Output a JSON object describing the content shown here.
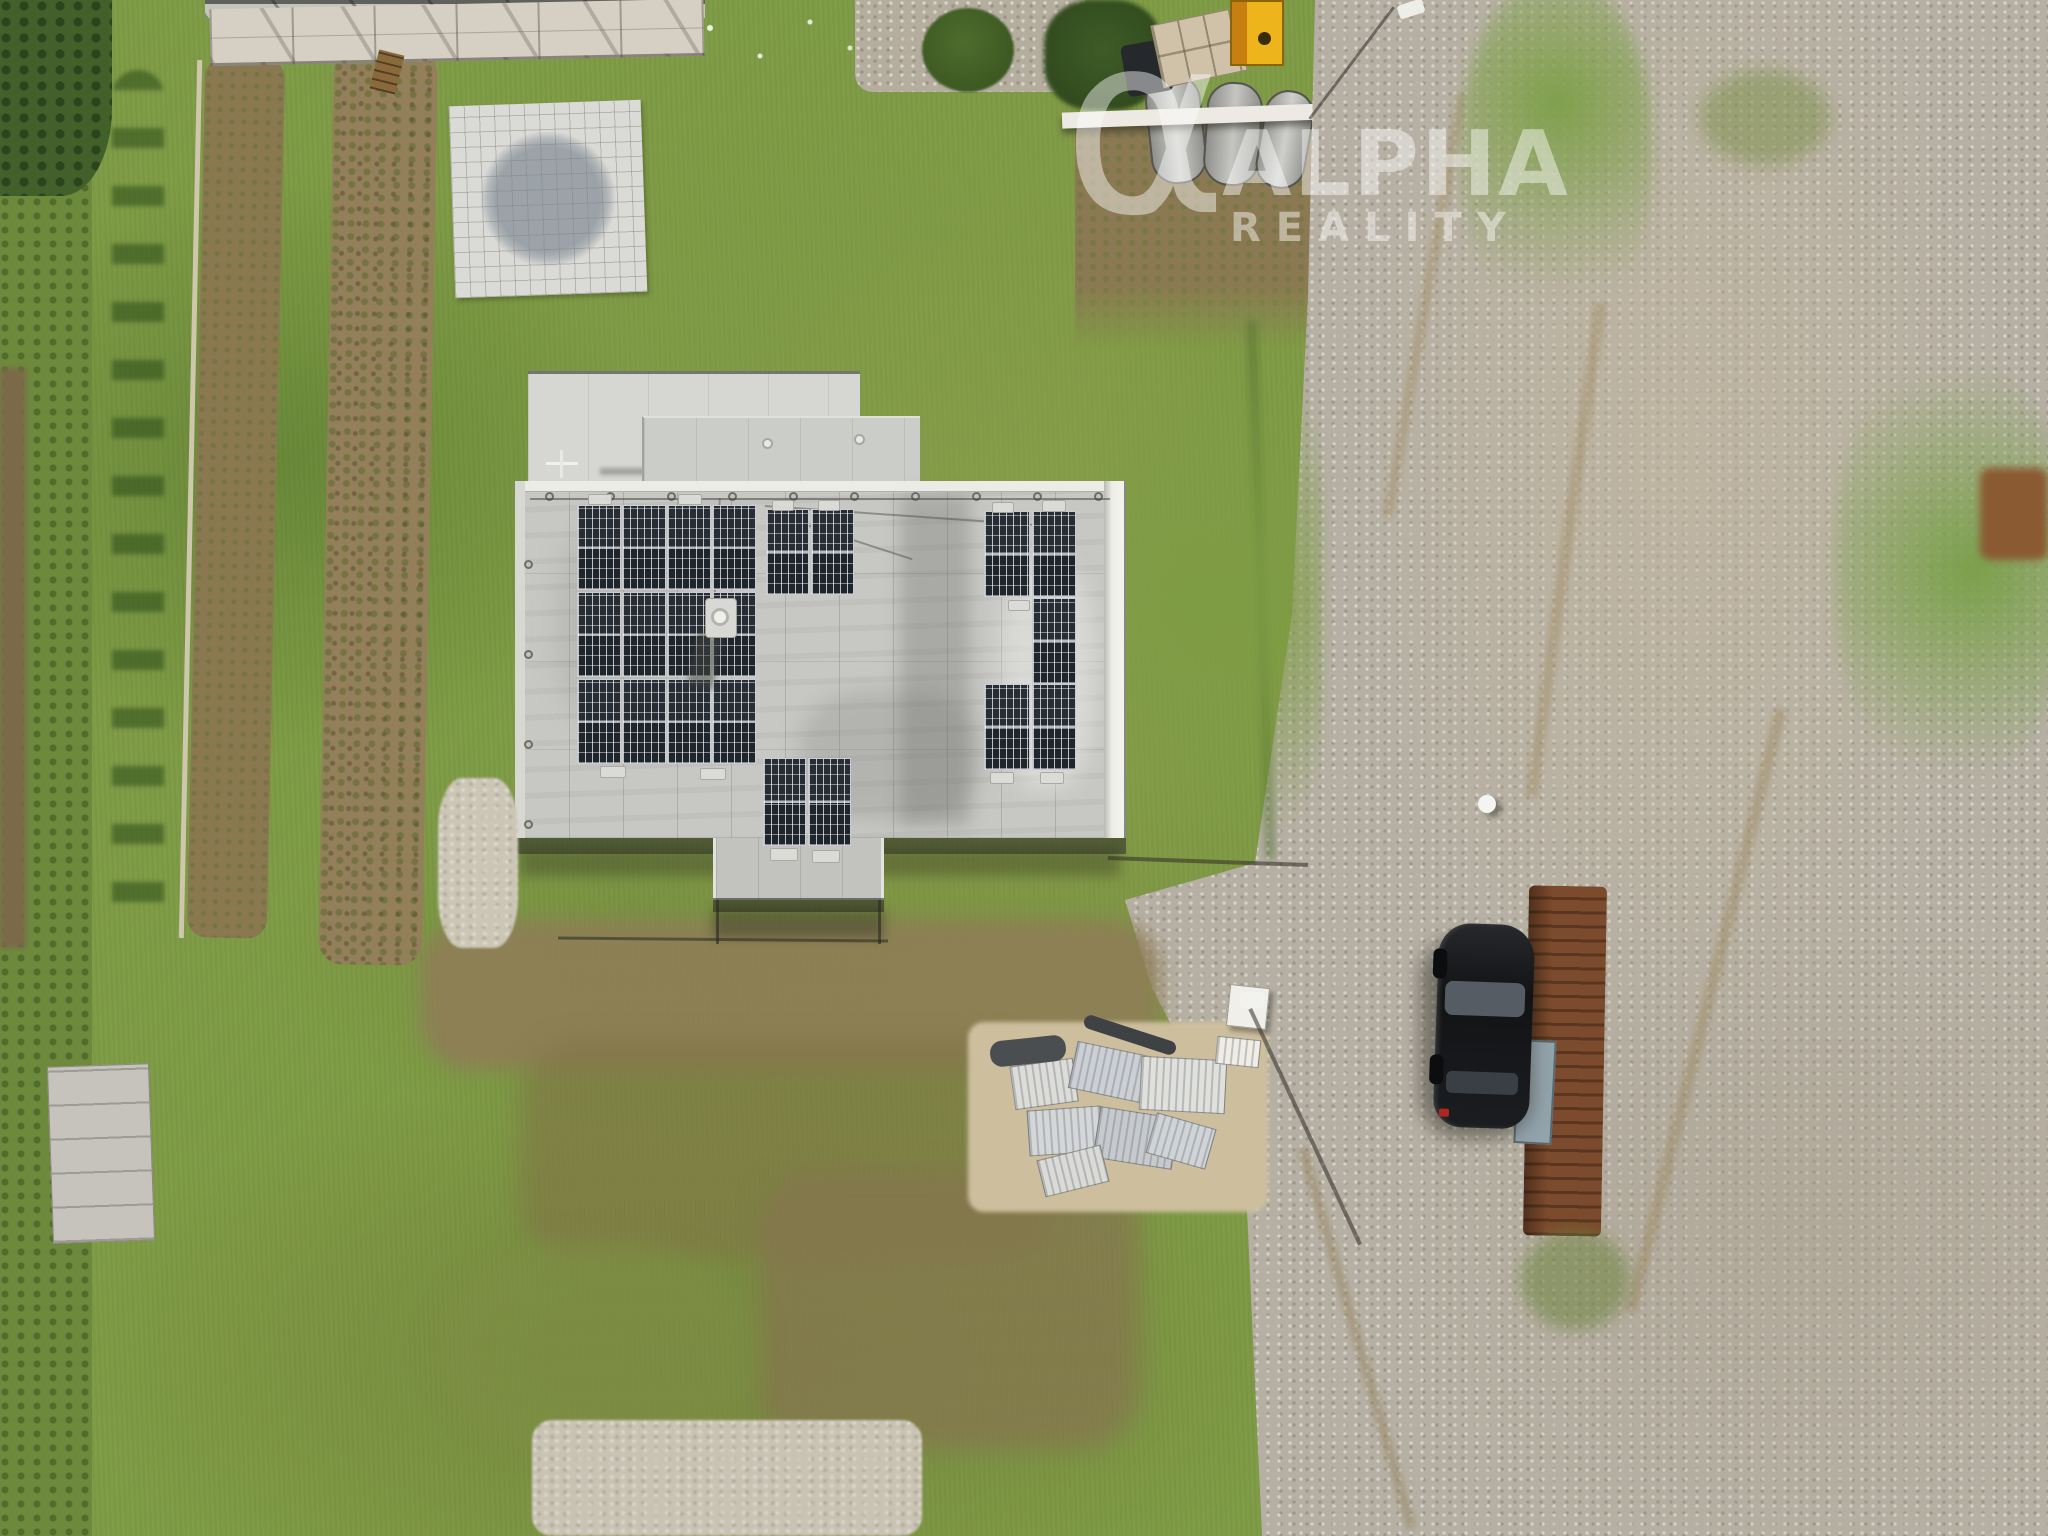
{
  "watermark": {
    "symbol": "α",
    "title": "ALPHA",
    "subtitle": "REALITY",
    "color": "#ffffff",
    "opacity": 0.45
  },
  "scene": {
    "view": "aerial top-down drone photo",
    "property": {
      "house": "flat-roof single family house with weathered gray concrete roof",
      "solar_arrays": {
        "left_block": {
          "columns": 4,
          "rows": 3
        },
        "middle_top_block": {
          "columns": 2,
          "rows": 1
        },
        "middle_bottom_block": {
          "columns": 2,
          "rows": 1
        },
        "right_block": {
          "panels": 5
        },
        "total_panels": 21
      },
      "rooftop_ac_unit": 1,
      "paved_patio": "square tiled patio with gray circular mosaic",
      "garden": "lawn with two brown planting strips and row of shrubs",
      "materials_pile": "stacked paving slabs on sand",
      "vehicle": {
        "type": "car",
        "color": "black",
        "count": 1
      },
      "utility_box_color": "#edb41c",
      "road": "gravel access road on right side"
    }
  },
  "palette": {
    "grass": "#7f9c46",
    "grass_dark": "#4e6d2c",
    "roof": "#c7c7c4",
    "roof_parapet": "#ecece7",
    "solar_panel": "#242a32",
    "dirt": "#8a7850",
    "gravel_road": "#b6b0a4",
    "patio_tile": "#dadad6",
    "patio_circle": "#9ba3a9",
    "yellow_box": "#edb41c",
    "car": "#17181a",
    "rust": "#7c4a2c",
    "watermark": "#ffffff"
  }
}
